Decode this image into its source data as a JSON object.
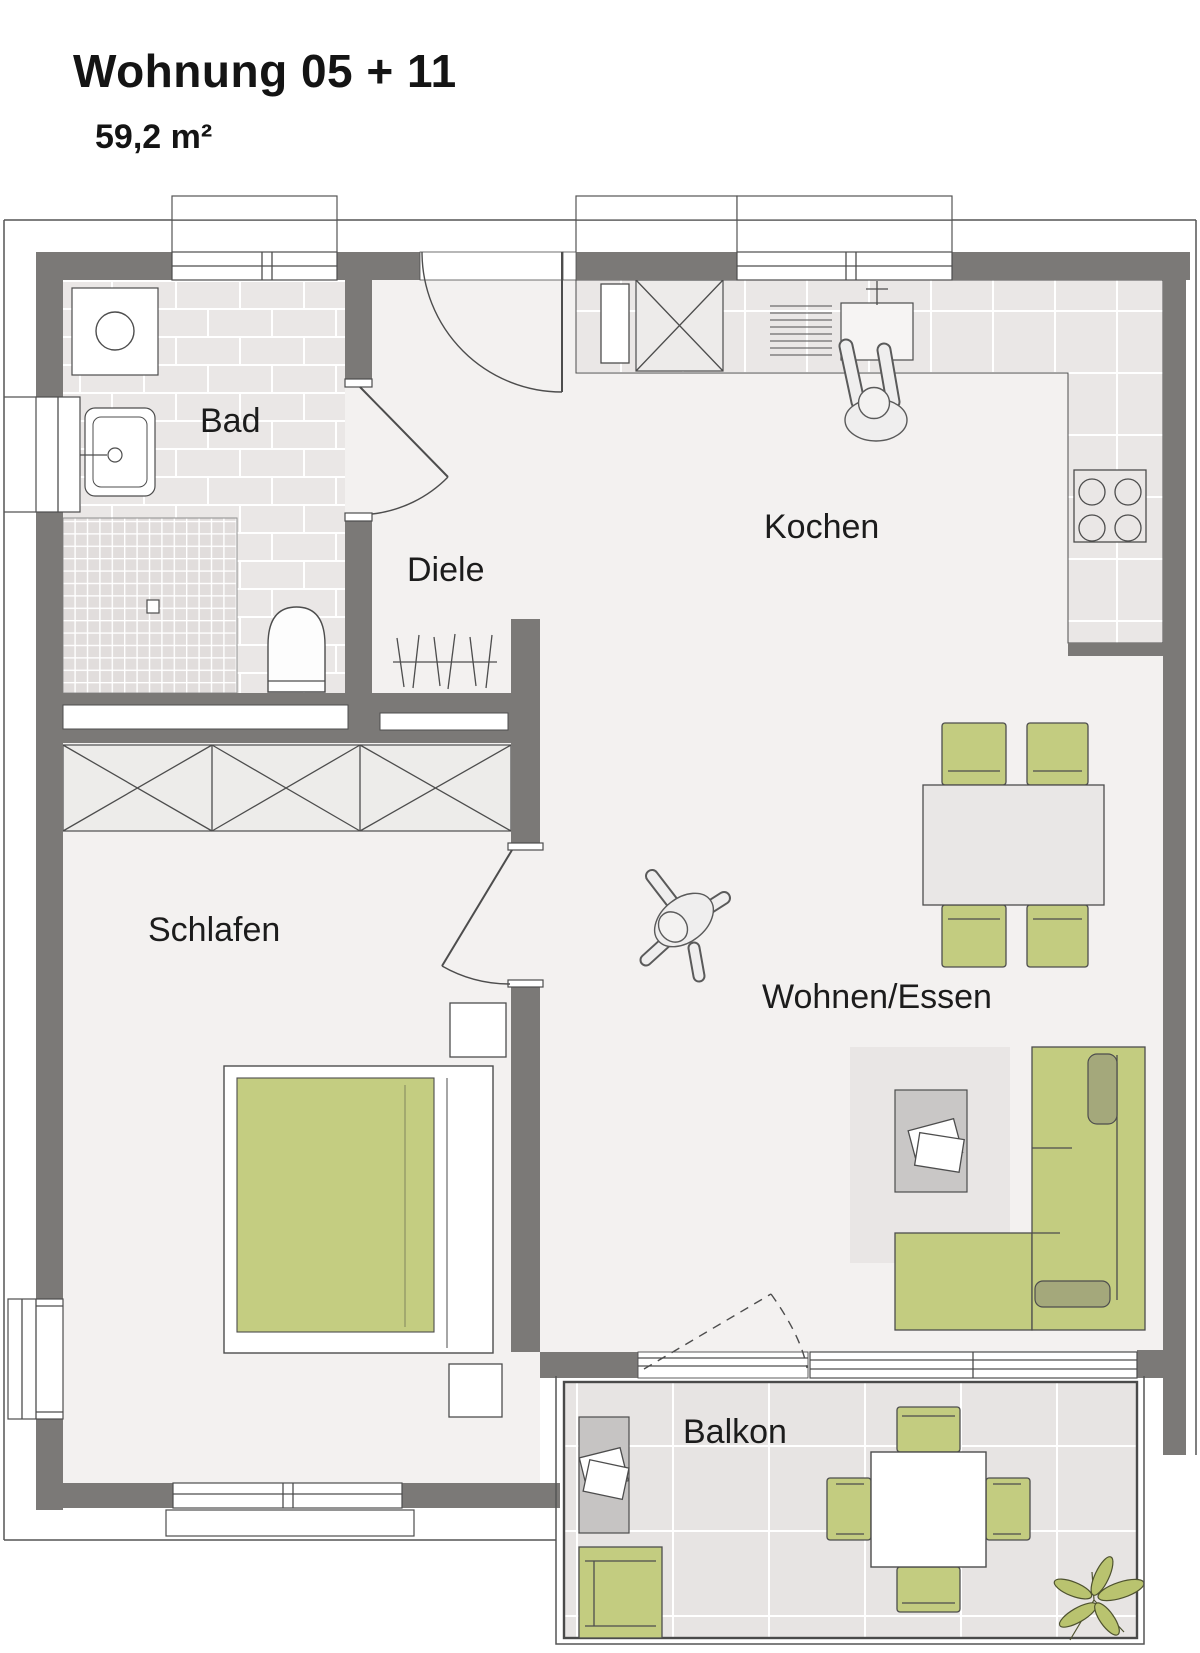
{
  "title": "Wohnung 05 + 11",
  "area_label": "59,2 m²",
  "rooms": [
    {
      "id": "bad",
      "label": "Bad"
    },
    {
      "id": "diele",
      "label": "Diele"
    },
    {
      "id": "kochen",
      "label": "Kochen"
    },
    {
      "id": "schlafen",
      "label": "Schlafen"
    },
    {
      "id": "wohnen_essen",
      "label": "Wohnen/Essen"
    },
    {
      "id": "balkon",
      "label": "Balkon"
    }
  ],
  "colors": {
    "wall": "#7b7977",
    "outline": "#4d4d4d",
    "floor": "#f3f1f0",
    "tile": "#eae7e6",
    "shower_tile": "#e1dddc",
    "balcony_tile": "#e7e4e3",
    "furniture_green": "#c3cc80",
    "cushion_green": "#a4a87b",
    "rug_gray": "#e9e6e5",
    "table_gray": "#c9c7c6",
    "text": "#1c1c1c"
  },
  "icons": {
    "bathroom": [
      "washing-machine",
      "washbasin",
      "shower",
      "toilet"
    ],
    "kitchen": [
      "tall-cabinet",
      "dish-rack",
      "kitchen-sink",
      "stove-4-burners",
      "kitchen-counter"
    ],
    "hall": [
      "coat-rack"
    ],
    "bedroom": [
      "wardrobe-3-sections",
      "double-bed",
      "nightstand",
      "nightstand"
    ],
    "living": [
      "dining-table",
      "chair",
      "chair",
      "chair",
      "chair",
      "rug",
      "coffee-table",
      "magazines",
      "corner-sofa"
    ],
    "balcony": [
      "side-table",
      "magazines",
      "lounge-chair",
      "balcony-table",
      "chair",
      "chair",
      "chair",
      "chair",
      "plant"
    ],
    "people": [
      "person-at-kitchen-sink",
      "person-walking-living-room"
    ]
  }
}
